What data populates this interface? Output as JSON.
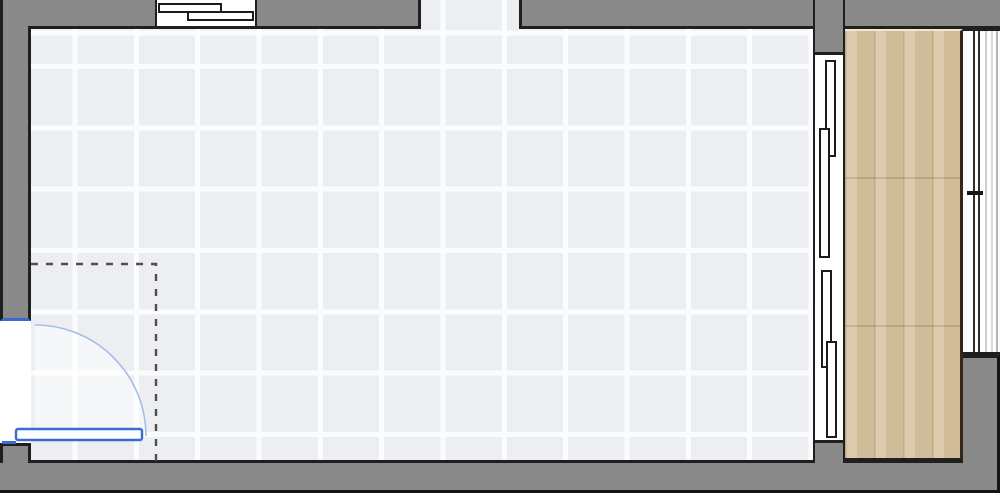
{
  "floorplan": {
    "type": "room-top-view",
    "colors": {
      "bg": "#ffffff",
      "wall": "#898989",
      "outline": "#1f1f1f",
      "outline_heavy": "#151515",
      "tile": "#eceef1",
      "grout": "#fbfcfd",
      "wood": "#d7c4a2",
      "wood_dark_edge": "#33281a",
      "wood_top_edge": "#f2e7cc",
      "blue": "#3a6bd2",
      "blue_light": "#a5bde8",
      "dash": "#4f4f4f",
      "glass_dark": "#2e2e2e",
      "glass_light": "#cfcfcf",
      "panel_border": "#1c1c1c",
      "white": "#ffffff"
    },
    "elements": {
      "room_floor": {
        "name": "tile-floor",
        "pattern": "square-grid"
      },
      "balcony_floor": {
        "name": "wood-floor",
        "pattern": "vertical-planks"
      },
      "door": {
        "name": "hinged-door",
        "swing": "quarter-arc",
        "accent": "#3a6bd2"
      },
      "clearance": {
        "name": "door-clearance-outline",
        "style": "dashed"
      },
      "top_window": {
        "name": "sliding-window",
        "panels": 2
      },
      "wall_opening": {
        "name": "open-passage"
      },
      "balcony_slider": {
        "name": "sliding-glass-door",
        "panels": 4
      },
      "right_window": {
        "name": "fixed-window",
        "panes": 2
      }
    }
  }
}
